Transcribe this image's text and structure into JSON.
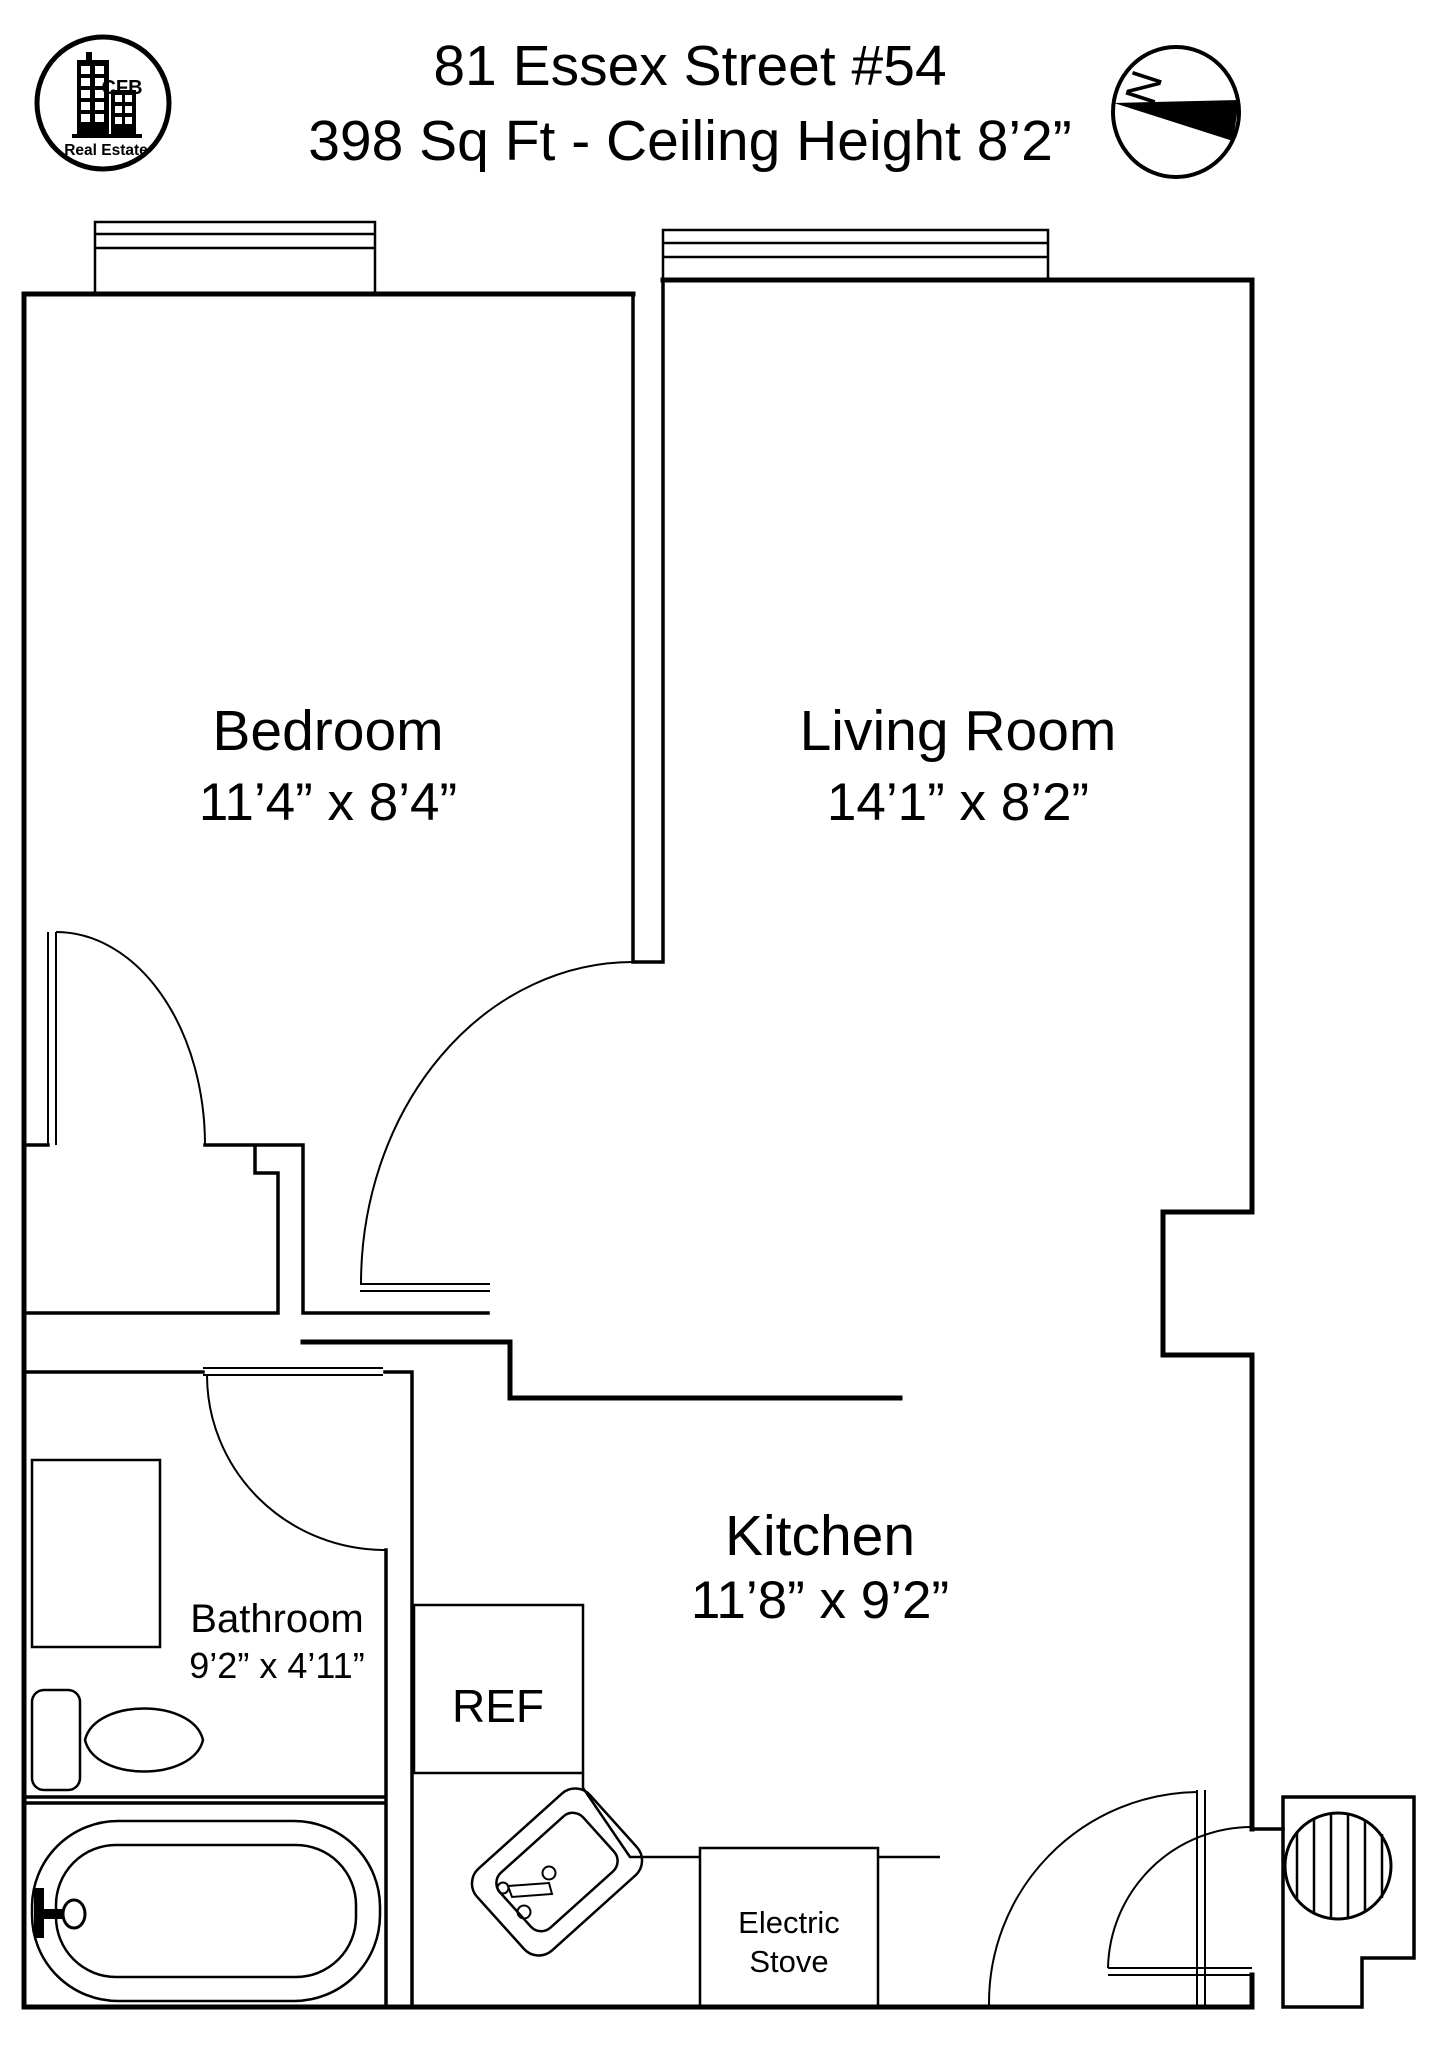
{
  "header": {
    "title_line1": "81 Essex Street #54",
    "title_line2": "398 Sq Ft - Ceiling Height 8’2”",
    "logo": {
      "acronym": "CFB",
      "subtitle": "Real Estate",
      "accent_color": "#1d4fa3"
    },
    "compass": {
      "north_label": "N"
    }
  },
  "rooms": {
    "bedroom": {
      "name": "Bedroom",
      "dims": "11’4” x 8’4”"
    },
    "living_room": {
      "name": "Living Room",
      "dims": "14’1” x 8’2”"
    },
    "kitchen": {
      "name": "Kitchen",
      "dims": "11’8” x 9’2”"
    },
    "bathroom": {
      "name": "Bathroom",
      "dims": "9’2” x 4’11”"
    }
  },
  "fixtures": {
    "refrigerator_label": "REF",
    "stove_label_line1": "Electric",
    "stove_label_line2": "Stove"
  },
  "colors": {
    "line": "#000000",
    "background": "#ffffff",
    "logo_blue": "#1d4fa3"
  }
}
